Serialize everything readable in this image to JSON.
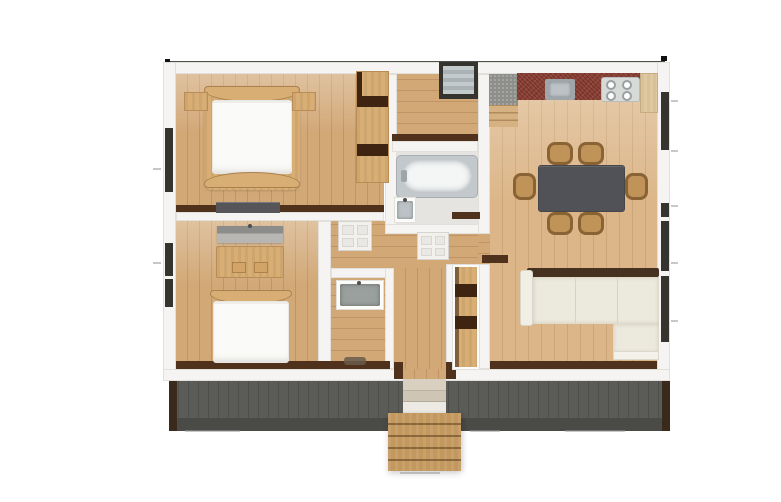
{
  "scene": {
    "name": "single-storey-house-floor-plan",
    "view": "top-down-3d-render",
    "visible_text": "none"
  },
  "palette": {
    "bg": "#ffffff",
    "wall": "#f5f4f2",
    "wall-edge": "#e2e0db",
    "wood-floor": "#d2a877",
    "wood-floor-line": "#c19467",
    "wood-floor-light": "#dcb689",
    "wood-floor-light-line": "#cba676",
    "wood-furniture": "#d8ae74",
    "wood-cabinet": "#e0c9a0",
    "wardrobe-dark": "#3f2412",
    "brown-dark": "#4f311c",
    "mattress": "#fafaf8",
    "bath-floor": "#e6e4e0",
    "tub-surround": "#c2c8cb",
    "tub": "#f4f6f6",
    "steel": "#9fa6a9",
    "counter-red": "#8d4034",
    "stair-landing": "#8e8e8a",
    "stair-wood": "#d6b181",
    "table": "#515257",
    "chair-wood": "#c09358",
    "chair-dark": "#8a6334",
    "sofa": "#ece9dd",
    "sofa-back": "#46301f",
    "deck": "#5b5c58",
    "deck-line": "#4e4f4b",
    "deck-band": "#4a4b47",
    "post": "#3a2a1c",
    "ext-stair": "#c3985f",
    "window-frame": "#35342f",
    "shelf-gray-top": "#8c8c8a",
    "shelf-gray-bottom": "#b8b6b2"
  },
  "rooms": [
    {
      "name": "bedroom-1",
      "furniture": [
        "double-bed",
        "nightstand-left",
        "nightstand-right",
        "open-wardrobe-shelving",
        "low-dresser"
      ]
    },
    {
      "name": "bedroom-2",
      "furniture": [
        "wall-shelf",
        "desk-with-drawers",
        "single-bed"
      ]
    },
    {
      "name": "hallway",
      "furniture": [
        "window-bay",
        "door-leaf-a",
        "door-leaf-b"
      ]
    },
    {
      "name": "bathroom",
      "furniture": [
        "bathtub",
        "vanity-sink"
      ]
    },
    {
      "name": "utility-wc",
      "furniture": [
        "laundry-sink",
        "floor-mat"
      ]
    },
    {
      "name": "entry-closet",
      "furniture": [
        "shelving-unit"
      ]
    },
    {
      "name": "kitchen-dining",
      "furniture": [
        "interior-staircase",
        "kitchen-counter",
        "kitchen-sink",
        "cooktop-4-burners",
        "tall-cabinet",
        "dining-table",
        "six-chairs"
      ]
    },
    {
      "name": "living-area",
      "furniture": [
        "l-shaped-sectional-sofa"
      ]
    },
    {
      "name": "exterior",
      "features": [
        "rear-deck",
        "entry-steps",
        "exterior-wood-stairs",
        "dimension-line",
        "dimension-markers"
      ]
    }
  ]
}
